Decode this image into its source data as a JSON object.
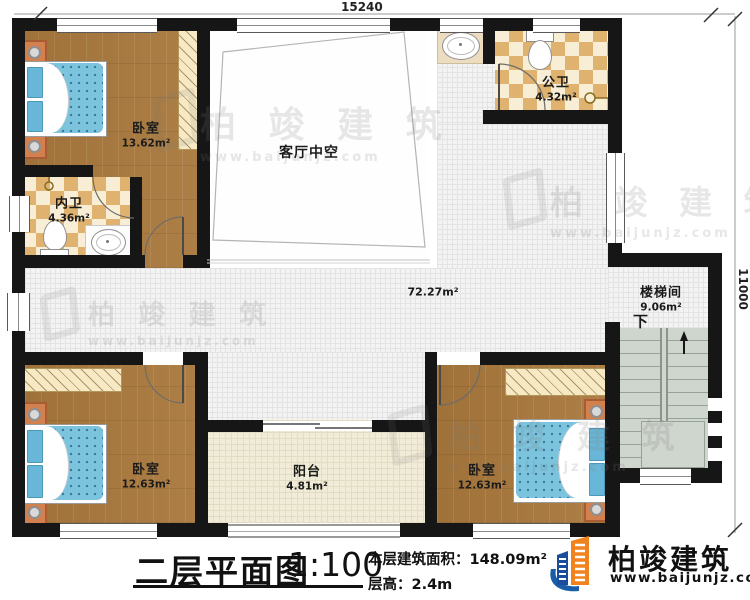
{
  "dimensions": {
    "top": "15240",
    "right": "11000"
  },
  "rooms": [
    {
      "id": "bedroom-nw",
      "name": "卧室",
      "area": "13.62m²"
    },
    {
      "id": "bath-inner",
      "name": "内卫",
      "area": "4.36m²"
    },
    {
      "id": "living-void",
      "name": "客厅中空",
      "area": ""
    },
    {
      "id": "bath-public",
      "name": "公卫",
      "area": "4.32m²"
    },
    {
      "id": "corridor",
      "name": "",
      "area": "72.27m²"
    },
    {
      "id": "stair-hall",
      "name": "楼梯间",
      "area": "9.06m²",
      "direction": "下"
    },
    {
      "id": "bedroom-sw",
      "name": "卧室",
      "area": "12.63m²"
    },
    {
      "id": "balcony",
      "name": "阳台",
      "area": "4.81m²"
    },
    {
      "id": "bedroom-se",
      "name": "卧室",
      "area": "12.63m²"
    }
  ],
  "title_block": {
    "title": "二层平面图",
    "scale": "1:100",
    "floor_area_label": "本层建筑面积：",
    "floor_area_value": "148.09m²",
    "floor_height_label": "层高：",
    "floor_height_value": "2.4m"
  },
  "logo": {
    "company": "柏竣建筑",
    "website": "www.baijunjz.com"
  },
  "watermark": {
    "company": "柏 竣 建 筑",
    "website": "www.baijunjz.com"
  },
  "colors": {
    "wall": "#161616",
    "wood_floor": "#a8783c",
    "tile_floor": "#f3f3f3",
    "checker_tile": "#dfb36f",
    "balcony_floor": "#f1ecd8",
    "stairs": "#cfd6cd",
    "bed_blue": "#7cc4dd",
    "nightstand_orange": "#d2804d",
    "logo_orange": "#f0831e",
    "logo_blue": "#1a4e9c"
  }
}
